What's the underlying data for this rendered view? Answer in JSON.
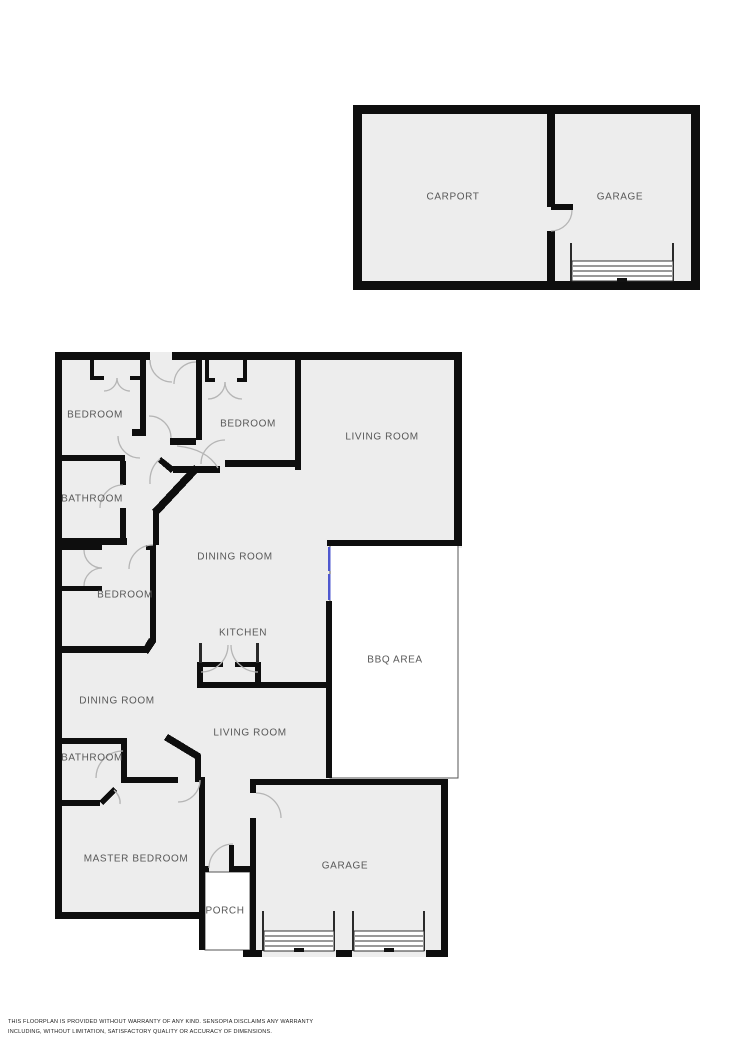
{
  "rooms": {
    "carport": "CARPORT",
    "garage_upper": "GARAGE",
    "bedroom_1": "BEDROOM",
    "bedroom_2": "BEDROOM",
    "living_room_1": "LIVING ROOM",
    "bathroom_1": "BATHROOM",
    "dining_room_1": "DINING ROOM",
    "bedroom_3": "BEDROOM",
    "kitchen": "KITCHEN",
    "bbq_area": "BBQ AREA",
    "dining_room_2": "DINING ROOM",
    "living_room_2": "LIVING ROOM",
    "bathroom_2": "BATHROOM",
    "master_bedroom": "MASTER BEDROOM",
    "garage_main": "GARAGE",
    "porch": "PORCH"
  },
  "disclaimer": {
    "line1": "THIS FLOORPLAN IS PROVIDED WITHOUT WARRANTY OF ANY KIND. SENSOPIA DISCLAIMS ANY WARRANTY",
    "line2": "INCLUDING, WITHOUT LIMITATION, SATISFACTORY QUALITY OR ACCURACY OF DIMENSIONS."
  },
  "colors": {
    "floor": "#ededed",
    "wall": "#0e0e0e",
    "white": "#ffffff",
    "arc": "#b5b5b5",
    "window": "#4f58cf",
    "label": "#585858",
    "disclaimer": "#1c1c1c",
    "thin": "#2a2a2a"
  }
}
